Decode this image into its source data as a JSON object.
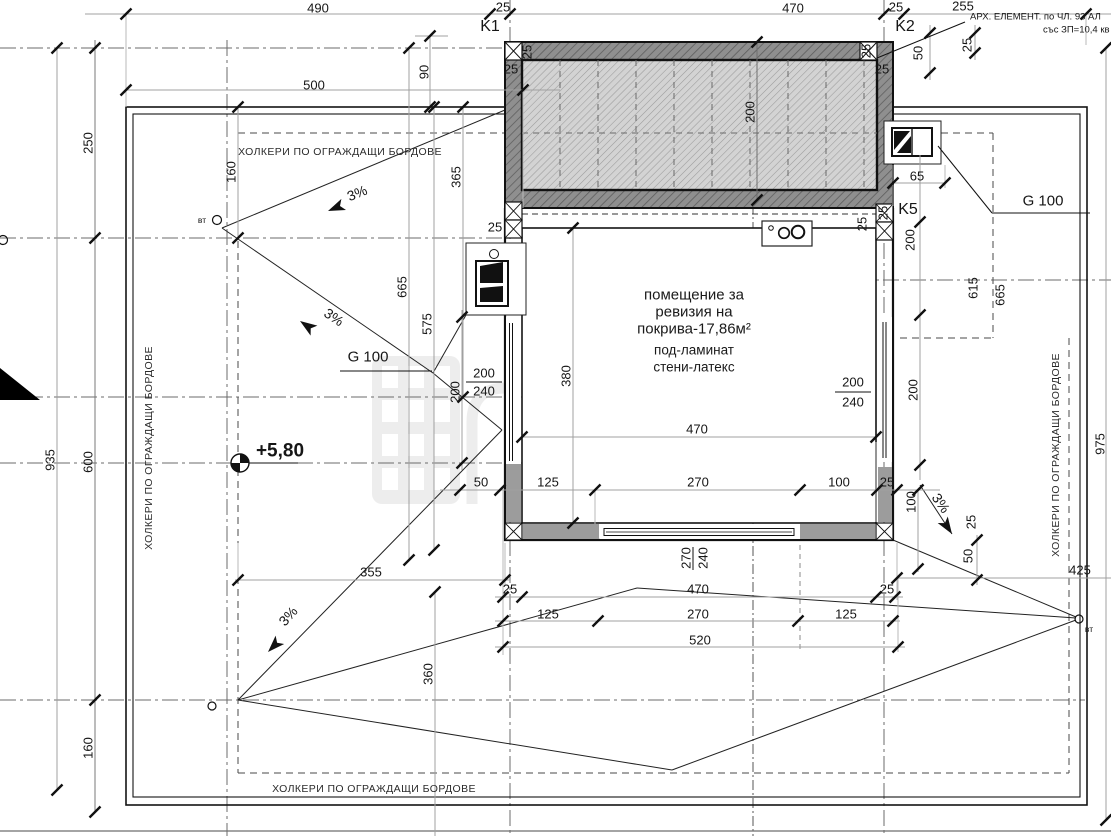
{
  "annotations": {
    "k1": "K1",
    "k2": "K2",
    "k5": "K5",
    "g100": "G 100",
    "elevation": "+5,80",
    "vt": "вт",
    "arch_note_line1": "АРХ. ЕЛЕМЕНТ. по ЧЛ. 93 АЛ",
    "arch_note_line2": "със ЗП=10,4 кв"
  },
  "notes": {
    "holker": "ХОЛКЕРИ ПО ОГРАЖДАЩИ БОРДОВЕ",
    "slope": "3%"
  },
  "room": {
    "line1": "помещение за",
    "line2": "ревизия на",
    "line3": "покрива-17,86м²",
    "line4": "под-ламинат",
    "line5": "стени-латекс"
  },
  "watermark": {
    "line1": "CLOUD",
    "line2": "HOMES"
  },
  "dims": {
    "v490": "490",
    "v470": "470",
    "v500": "500",
    "v255": "255",
    "v250": "250",
    "v935": "935",
    "v600": "600",
    "v975": "975",
    "v665": "665",
    "v615": "615",
    "v575": "575",
    "v365": "365",
    "v380": "380",
    "v360": "360",
    "v355": "355",
    "v520": "520",
    "v425": "425",
    "v270": "270",
    "v240": "240",
    "v200": "200",
    "v160": "160",
    "v125": "125",
    "v100": "100",
    "v90": "90",
    "v65": "65",
    "v50": "50",
    "v25": "25"
  },
  "colors": {
    "wall_fill": "#9c9c9c",
    "hatch_dark_bg": "#8f8f8f",
    "hatch_light_bg": "#d3d3d3",
    "line": "#161616"
  }
}
